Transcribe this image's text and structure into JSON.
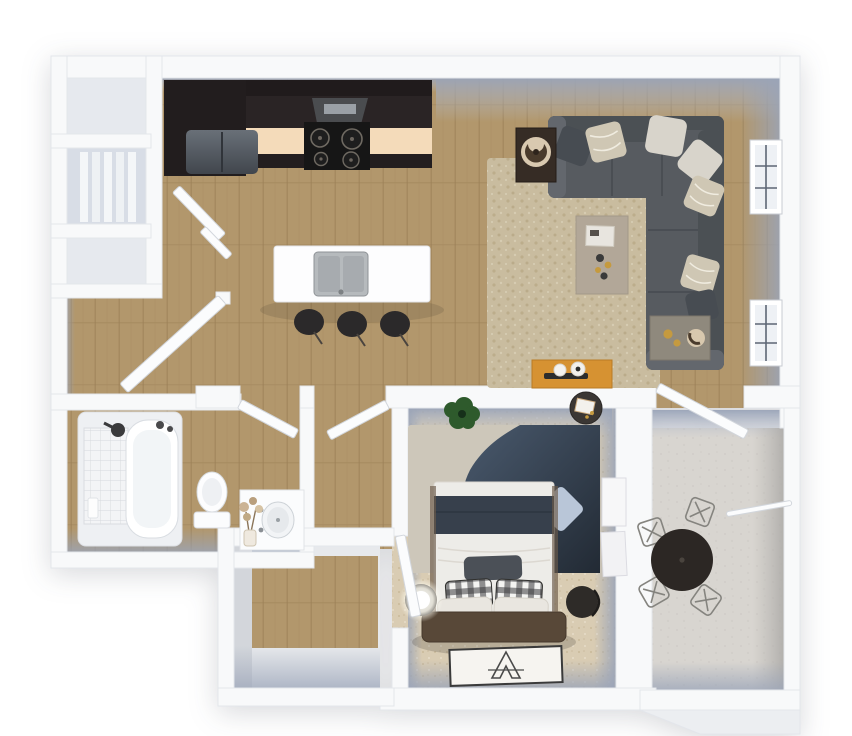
{
  "meta": {
    "title": "3D one-bedroom apartment floor plan render",
    "view": "top-down dollhouse view, no text labels"
  },
  "palette": {
    "bg": "#ffffff",
    "wall": "#f8f9fa",
    "wall_face_blue": "#9aa4b8",
    "wall_face_gray": "#b6b4b1",
    "wood_base": "#b2976c",
    "wood_line": "#9a7f55",
    "carpet_base": "#d9ccb3",
    "rug_living_base": "#c9bc9f",
    "rug_bed_light": "#cdc7ba",
    "rug_bed_navy": "#45566a",
    "rug_bed_navy_dark": "#242c36",
    "concrete": "#d8d5d0",
    "tile": "#f3f4f6",
    "closet_floor": "#e6e9ee",
    "shelf": "#f4f6f8",
    "cabinet_dark": "#2a2425",
    "cabinet_tall": "#221d1e",
    "counter_cream": "#f4dbba",
    "counter_front": "#231e1f",
    "fridge": "#565c63",
    "hood": "#4a4c4f",
    "stove_black": "#161616",
    "burner_ring": "#6f6a62",
    "island_white": "#fdfdfe",
    "sink_steel": "#b6babd",
    "sink_basin": "#a7abaf",
    "stool_dark": "#2b292a",
    "sofa": "#575b60",
    "sofa_back": "#4b5054",
    "sofa_arm": "#63676d",
    "pillow_light": "#d8d4cb",
    "pillow_pattern": "#cfc7b4",
    "pillow_dark": "#474c52",
    "coffee_table": "#b2a798",
    "lamp_table": "#362c25",
    "lamp_shade": "#d9c9b0",
    "end_table": "#8f897d",
    "console_orange": "#d69232",
    "window_frame": "#ffffff",
    "window_glass": "#eef1f5",
    "muntin": "#5d6675",
    "bed_duvet": "#edece8",
    "bed_navy": "#37404c",
    "bed_gray_pillow": "#4b5057",
    "headboard": "#584838",
    "gingham": "#3a3a3e",
    "pillow_blue": "#b9c6d8",
    "plant_green": "#2e5a2c",
    "nightstand_dark": "#332f2c",
    "lamp_glow": "#ffffff",
    "art_white": "#f7f7f8",
    "eiffel_ink": "#4a4a4a",
    "tub_white": "#ffffff",
    "tub_deck": "#eef0f3",
    "balcony_table": "#2c2724",
    "chair_wire": "#85847f",
    "door_white": "#fbfcfd",
    "gold_accent": "#c59a3f"
  },
  "rooms": [
    {
      "id": "storage-closets",
      "label": "Storage closets (3 cells)",
      "furniture": [
        "empty closet",
        "linen closet with shelving",
        "utility closet"
      ]
    },
    {
      "id": "kitchen",
      "label": "Kitchen",
      "furniture": [
        "dark upper cabinets",
        "range hood",
        "black cooktop with 4 burners",
        "refrigerator",
        "cream countertop run",
        "white island",
        "double-basin steel sink",
        "three dark bar stools",
        "pantry door (open)"
      ]
    },
    {
      "id": "living-room",
      "label": "Living room",
      "furniture": [
        "L-shaped gray sectional sofa",
        "seven throw pillows",
        "beige shag area rug",
        "coffee table with tray and candles",
        "dark side table with round lamp",
        "end table with gold decor",
        "orange console with two white vases",
        "two grid-pane windows on right wall"
      ]
    },
    {
      "id": "entry",
      "label": "Entry",
      "furniture": [
        "front door (open)"
      ]
    },
    {
      "id": "bathroom",
      "label": "Bathroom",
      "furniture": [
        "tub with tiled surround",
        "shower head",
        "shampoo bottle",
        "toilet",
        "vanity with round sink",
        "dried flower arrangement",
        "door (open)"
      ]
    },
    {
      "id": "hallway",
      "label": "Hall",
      "furniture": [
        "door to bathroom",
        "door to bedroom suite"
      ]
    },
    {
      "id": "walk-in-closet",
      "label": "Walk-in closet",
      "furniture": []
    },
    {
      "id": "bedroom",
      "label": "Bedroom",
      "furniture": [
        "bed with white duvet and navy blanket",
        "two gingham pillows",
        "two white pillows",
        "gray lumbar pillow",
        "brown headboard",
        "two-tone area rug",
        "light-blue floor cushion",
        "potted plant",
        "round accent table",
        "nightstand with glowing lamp",
        "dark round side table",
        "Eiffel Tower floor art",
        "leaning white wall panels",
        "door (open)"
      ]
    },
    {
      "id": "balcony",
      "label": "Balcony / patio",
      "furniture": [
        "round bistro table",
        "four wire chairs",
        "railing",
        "door from living room (open)"
      ]
    }
  ]
}
